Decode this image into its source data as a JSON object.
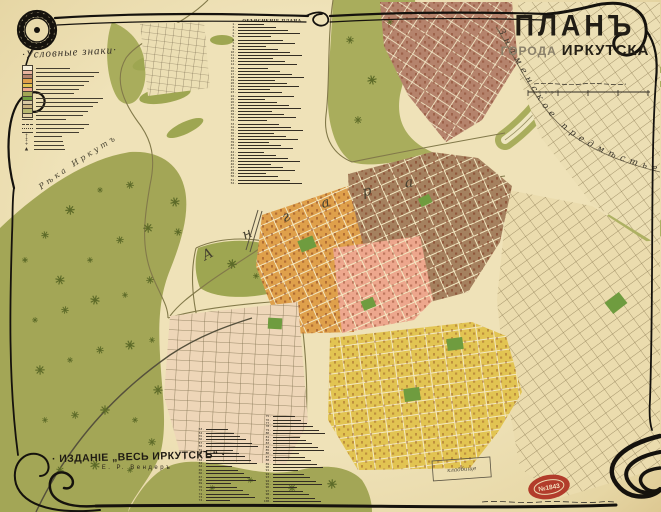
{
  "title": {
    "word_plan": "ПЛАНЪ",
    "word_gorod": "ГОРОДА",
    "word_city": "ИРКУТСКА"
  },
  "legend": {
    "header": "·Условные знаки·",
    "swatches": [
      "#f6efd9",
      "#e9b49e",
      "#b5836c",
      "#dfa04b",
      "#e2c452",
      "#eda78d",
      "#a3a656",
      "#6f9c3f",
      "#d9c9a2",
      "#c9b27e",
      "#b7b871",
      "#e6d3a8"
    ],
    "line_rows": 4,
    "symbol_rows": [
      "†",
      "‡",
      "+",
      "▲"
    ]
  },
  "explanation": {
    "header": "ОБЪЯСНЕНІЕ ПЛАНА",
    "top_rows": 52,
    "bottom_left_start": 53,
    "bottom_left_rows": 22,
    "bottom_right_start": 75,
    "bottom_right_rows": 26
  },
  "labels": {
    "river_main": "Ангара",
    "river_left": "Рѣка Иркутъ",
    "suburb": "Знаменское предмѣстье",
    "cemetery": "кладбище"
  },
  "imprint": {
    "line1": "· ИЗДАНІЕ „ВЕСЬ ИРКУТСКЪ“ ·",
    "line2": "Е. Р. Вендеръ"
  },
  "stamp": {
    "number": "№1843"
  },
  "notes": {
    "scale_caption_illegible": true,
    "fine_print_illegible": true,
    "list_text_illegible": true
  },
  "colors": {
    "paper": "#e9dcae",
    "forest": "#a3a656",
    "bank_green": "#a9ad5c",
    "orange": "#dfa04b",
    "pink": "#eda78d",
    "brown": "#a5815f",
    "brown_ne": "#b5836c",
    "yellow": "#e2c452",
    "cream": "#ecdfb4",
    "cream2": "#ebdcae",
    "glazkovo": "#eed6b8",
    "park": "#6f9c3f",
    "ink": "#15120d",
    "stamp_red": "#b23c2b",
    "water": "#efe6c0"
  }
}
